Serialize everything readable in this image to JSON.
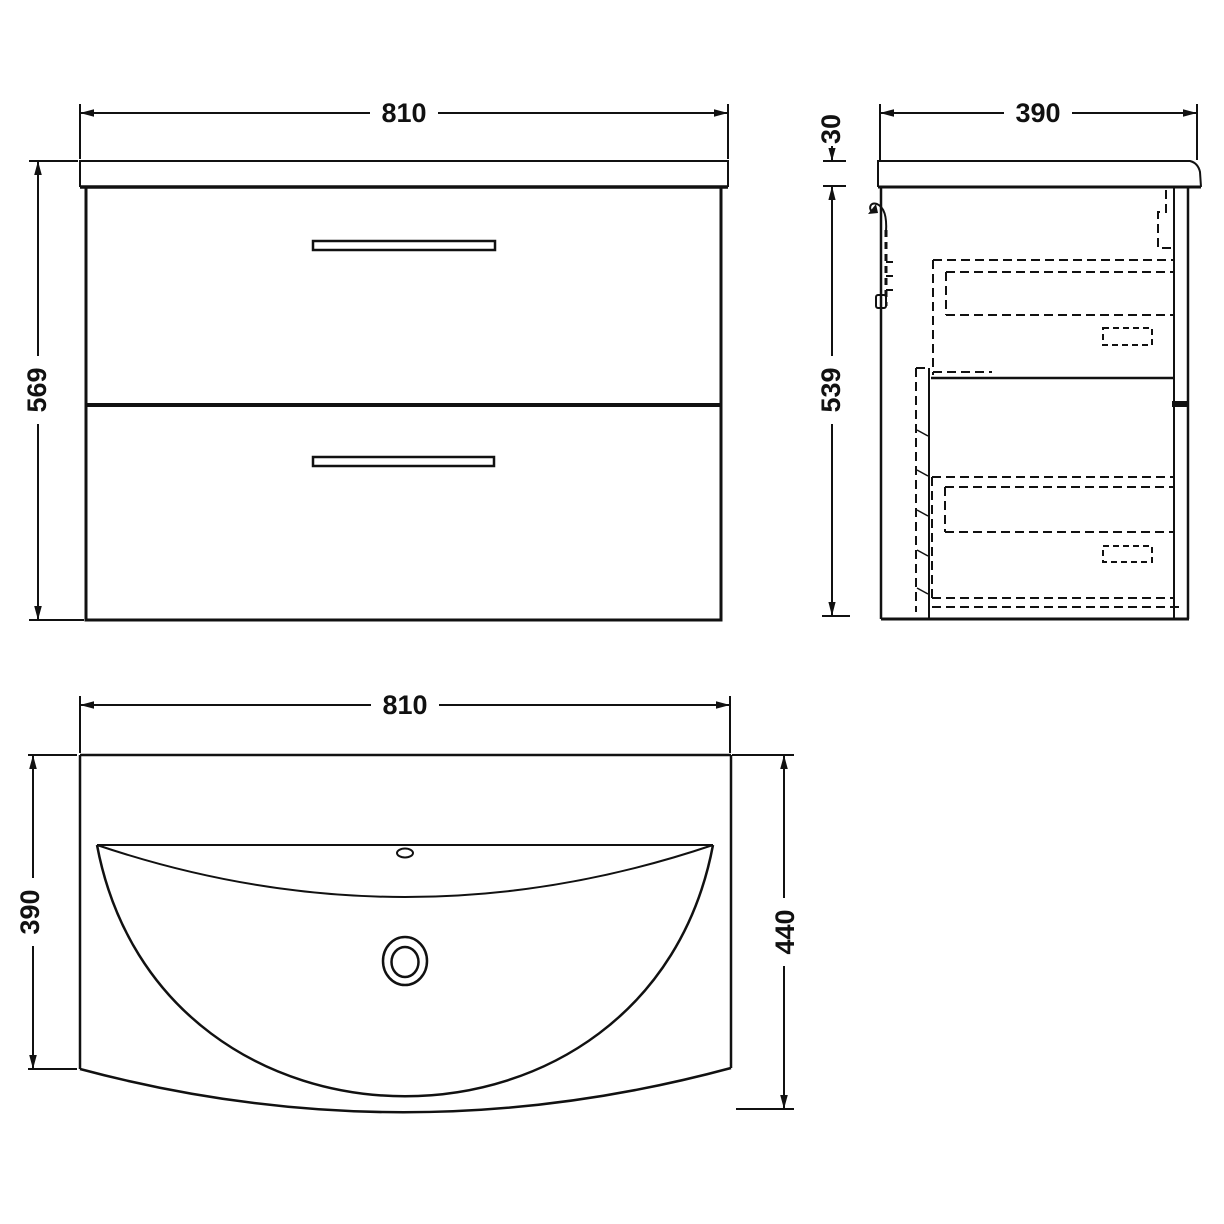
{
  "drawing": {
    "type": "technical-dimension-drawing",
    "subject": "wall-hung vanity unit with two drawers and curved basin",
    "line_color": "#111111",
    "background_color": "#ffffff",
    "views": {
      "front": {
        "description": "front elevation of vanity cabinet with worktop and two drawer handles"
      },
      "side": {
        "description": "side section showing worktop, wall bracket and hidden drawer boxes"
      },
      "plan": {
        "description": "top plan of curved ceramic basin with overflow and waste"
      }
    }
  },
  "dims": {
    "front_width": "810",
    "front_height": "569",
    "side_depth": "390",
    "worktop_thickness": "30",
    "side_cabinet_height": "539",
    "plan_width": "810",
    "plan_basin_depth": "390",
    "plan_total_depth": "440"
  }
}
